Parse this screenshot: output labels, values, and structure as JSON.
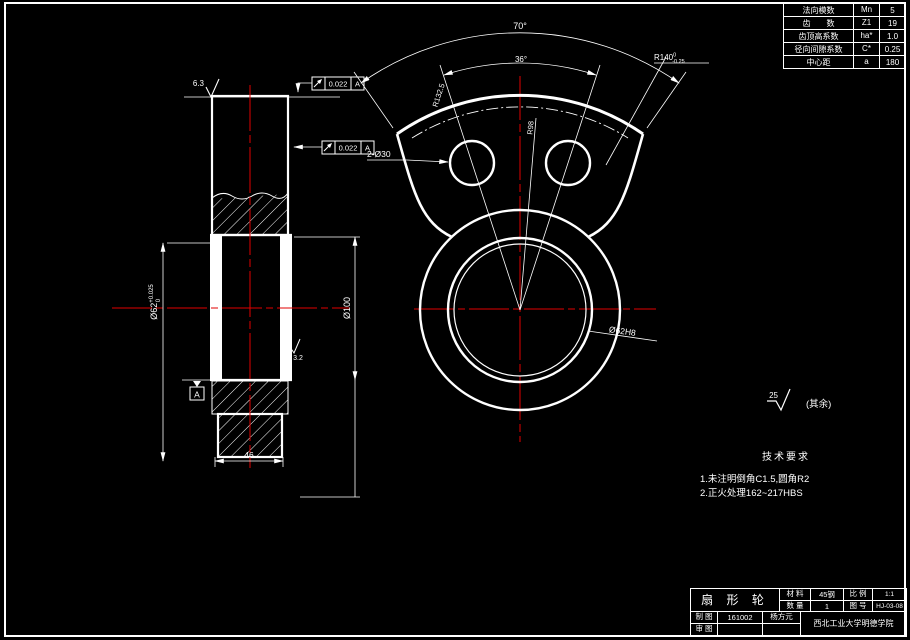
{
  "colors": {
    "background": "#000000",
    "line": "#ffffff",
    "centerline": "#e10000"
  },
  "param_table": {
    "rows": [
      {
        "label": "法向模数",
        "symbol": "Mn",
        "value": "5"
      },
      {
        "label": "齿　　数",
        "symbol": "Z1",
        "value": "19"
      },
      {
        "label": "齿顶高系数",
        "symbol": "ha*",
        "value": "1.0"
      },
      {
        "label": "径向间隙系数",
        "symbol": "C*",
        "value": "0.25"
      },
      {
        "label": "中心距",
        "symbol": "a",
        "value": "180"
      }
    ]
  },
  "title_block": {
    "part_name": "扇 形 轮",
    "material_label": "材 料",
    "material": "45钢",
    "scale_label": "比 例",
    "scale": "1:1",
    "quantity_label": "数 量",
    "quantity": "1",
    "drawing_no_label": "图 号",
    "drawing_no": "HJ-03-08",
    "drafter_label": "制 图",
    "drafter_id": "161002",
    "drafter_name": "杨方元",
    "checker_label": "审 图",
    "school": "西北工业大学明德学院"
  },
  "tech_req": {
    "heading": "技术要求",
    "line1": "1.未注明倒角C1.5,圆角R2",
    "line2": "2.正火处理162~217HBS"
  },
  "surface_note": {
    "value": "25",
    "scope": "(其余)"
  },
  "side_view": {
    "bore_dia": {
      "main": "Ø62",
      "sup": "+0.025",
      "sub": "0"
    },
    "hub_dia": "Ø100",
    "width": "46",
    "rough_top": "6.3",
    "rough_bore": "3.2",
    "datum": "A",
    "runout1": {
      "value": "0.022",
      "datum": "A"
    },
    "runout2": {
      "value": "0.022",
      "datum": "A"
    }
  },
  "front_view": {
    "angle_outer": "70°",
    "angle_inner": "36°",
    "tip_radius": {
      "main": "R140",
      "sup": "0",
      "sub": "-0.25"
    },
    "pitch_radius": "R132.5",
    "hole_circle_radius": "R98",
    "holes": "2-Ø30",
    "bore": "Ø62H8"
  }
}
